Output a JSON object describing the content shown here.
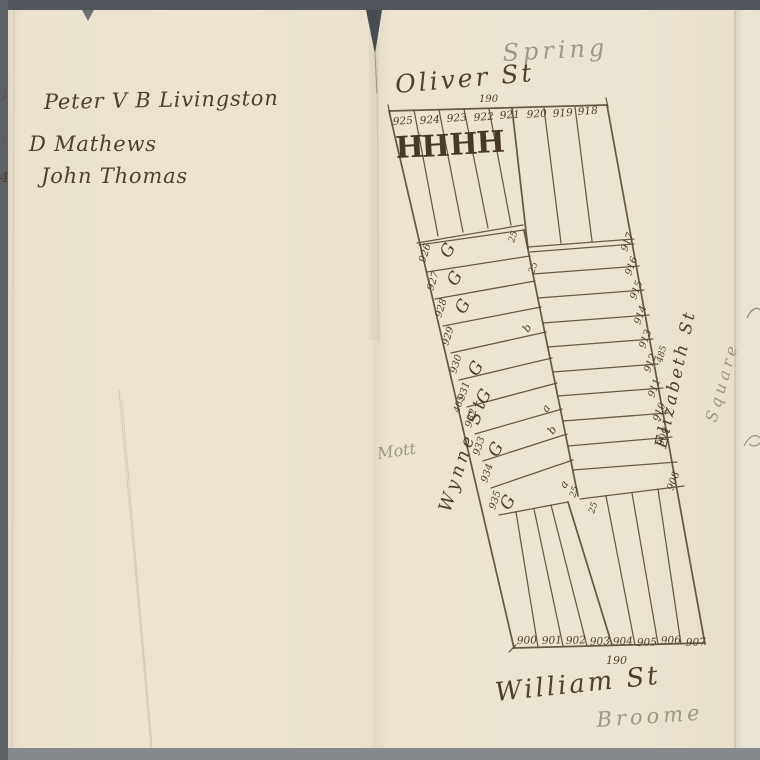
{
  "left_page": {
    "names": [
      "Peter V B Livingston",
      "D Mathews",
      "John Thomas"
    ],
    "margin_mark": "4"
  },
  "map": {
    "street_labels": {
      "spring": "Spring",
      "oliver": "Oliver St",
      "wynne": "Wynne St",
      "mott": "Mott",
      "elizabeth": "Elizabeth St",
      "square": "Square",
      "william": "William St",
      "broome": "Broome"
    },
    "dimensions": {
      "top": "190",
      "bottom": "190",
      "left_side": "485",
      "right_side": "485",
      "lot_depths": [
        "25",
        "25",
        "25",
        "25"
      ]
    },
    "top_block": {
      "left_lots": [
        "925",
        "924",
        "923",
        "922",
        "921"
      ],
      "right_lots": [
        "920",
        "919",
        "918"
      ],
      "house_letters": [
        "H",
        "H",
        "H",
        "H"
      ]
    },
    "middle_block": {
      "left_lots": [
        {
          "n": "926",
          "letter": "G"
        },
        {
          "n": "927",
          "letter": "G"
        },
        {
          "n": "928",
          "letter": "G"
        },
        {
          "n": "929",
          "letter": ""
        },
        {
          "n": "930",
          "letter": "G"
        },
        {
          "n": "931",
          "letter": "G"
        },
        {
          "n": "932",
          "letter": ""
        },
        {
          "n": "933",
          "letter": "G"
        },
        {
          "n": "934",
          "letter": ""
        },
        {
          "n": "935",
          "letter": "G"
        }
      ],
      "right_lots": [
        "917",
        "916",
        "915",
        "914",
        "913",
        "912",
        "911",
        "910",
        "909",
        "908"
      ],
      "interior_letters": [
        "b",
        "a",
        "b",
        "a"
      ]
    },
    "bottom_block": {
      "lots": [
        "900",
        "901",
        "902",
        "903",
        "904",
        "905",
        "906",
        "907"
      ]
    }
  },
  "colors": {
    "paper": "#ebe3d0",
    "ink": "#53432f",
    "pencil": "#9a9381",
    "border_gray": "#6e7277"
  }
}
